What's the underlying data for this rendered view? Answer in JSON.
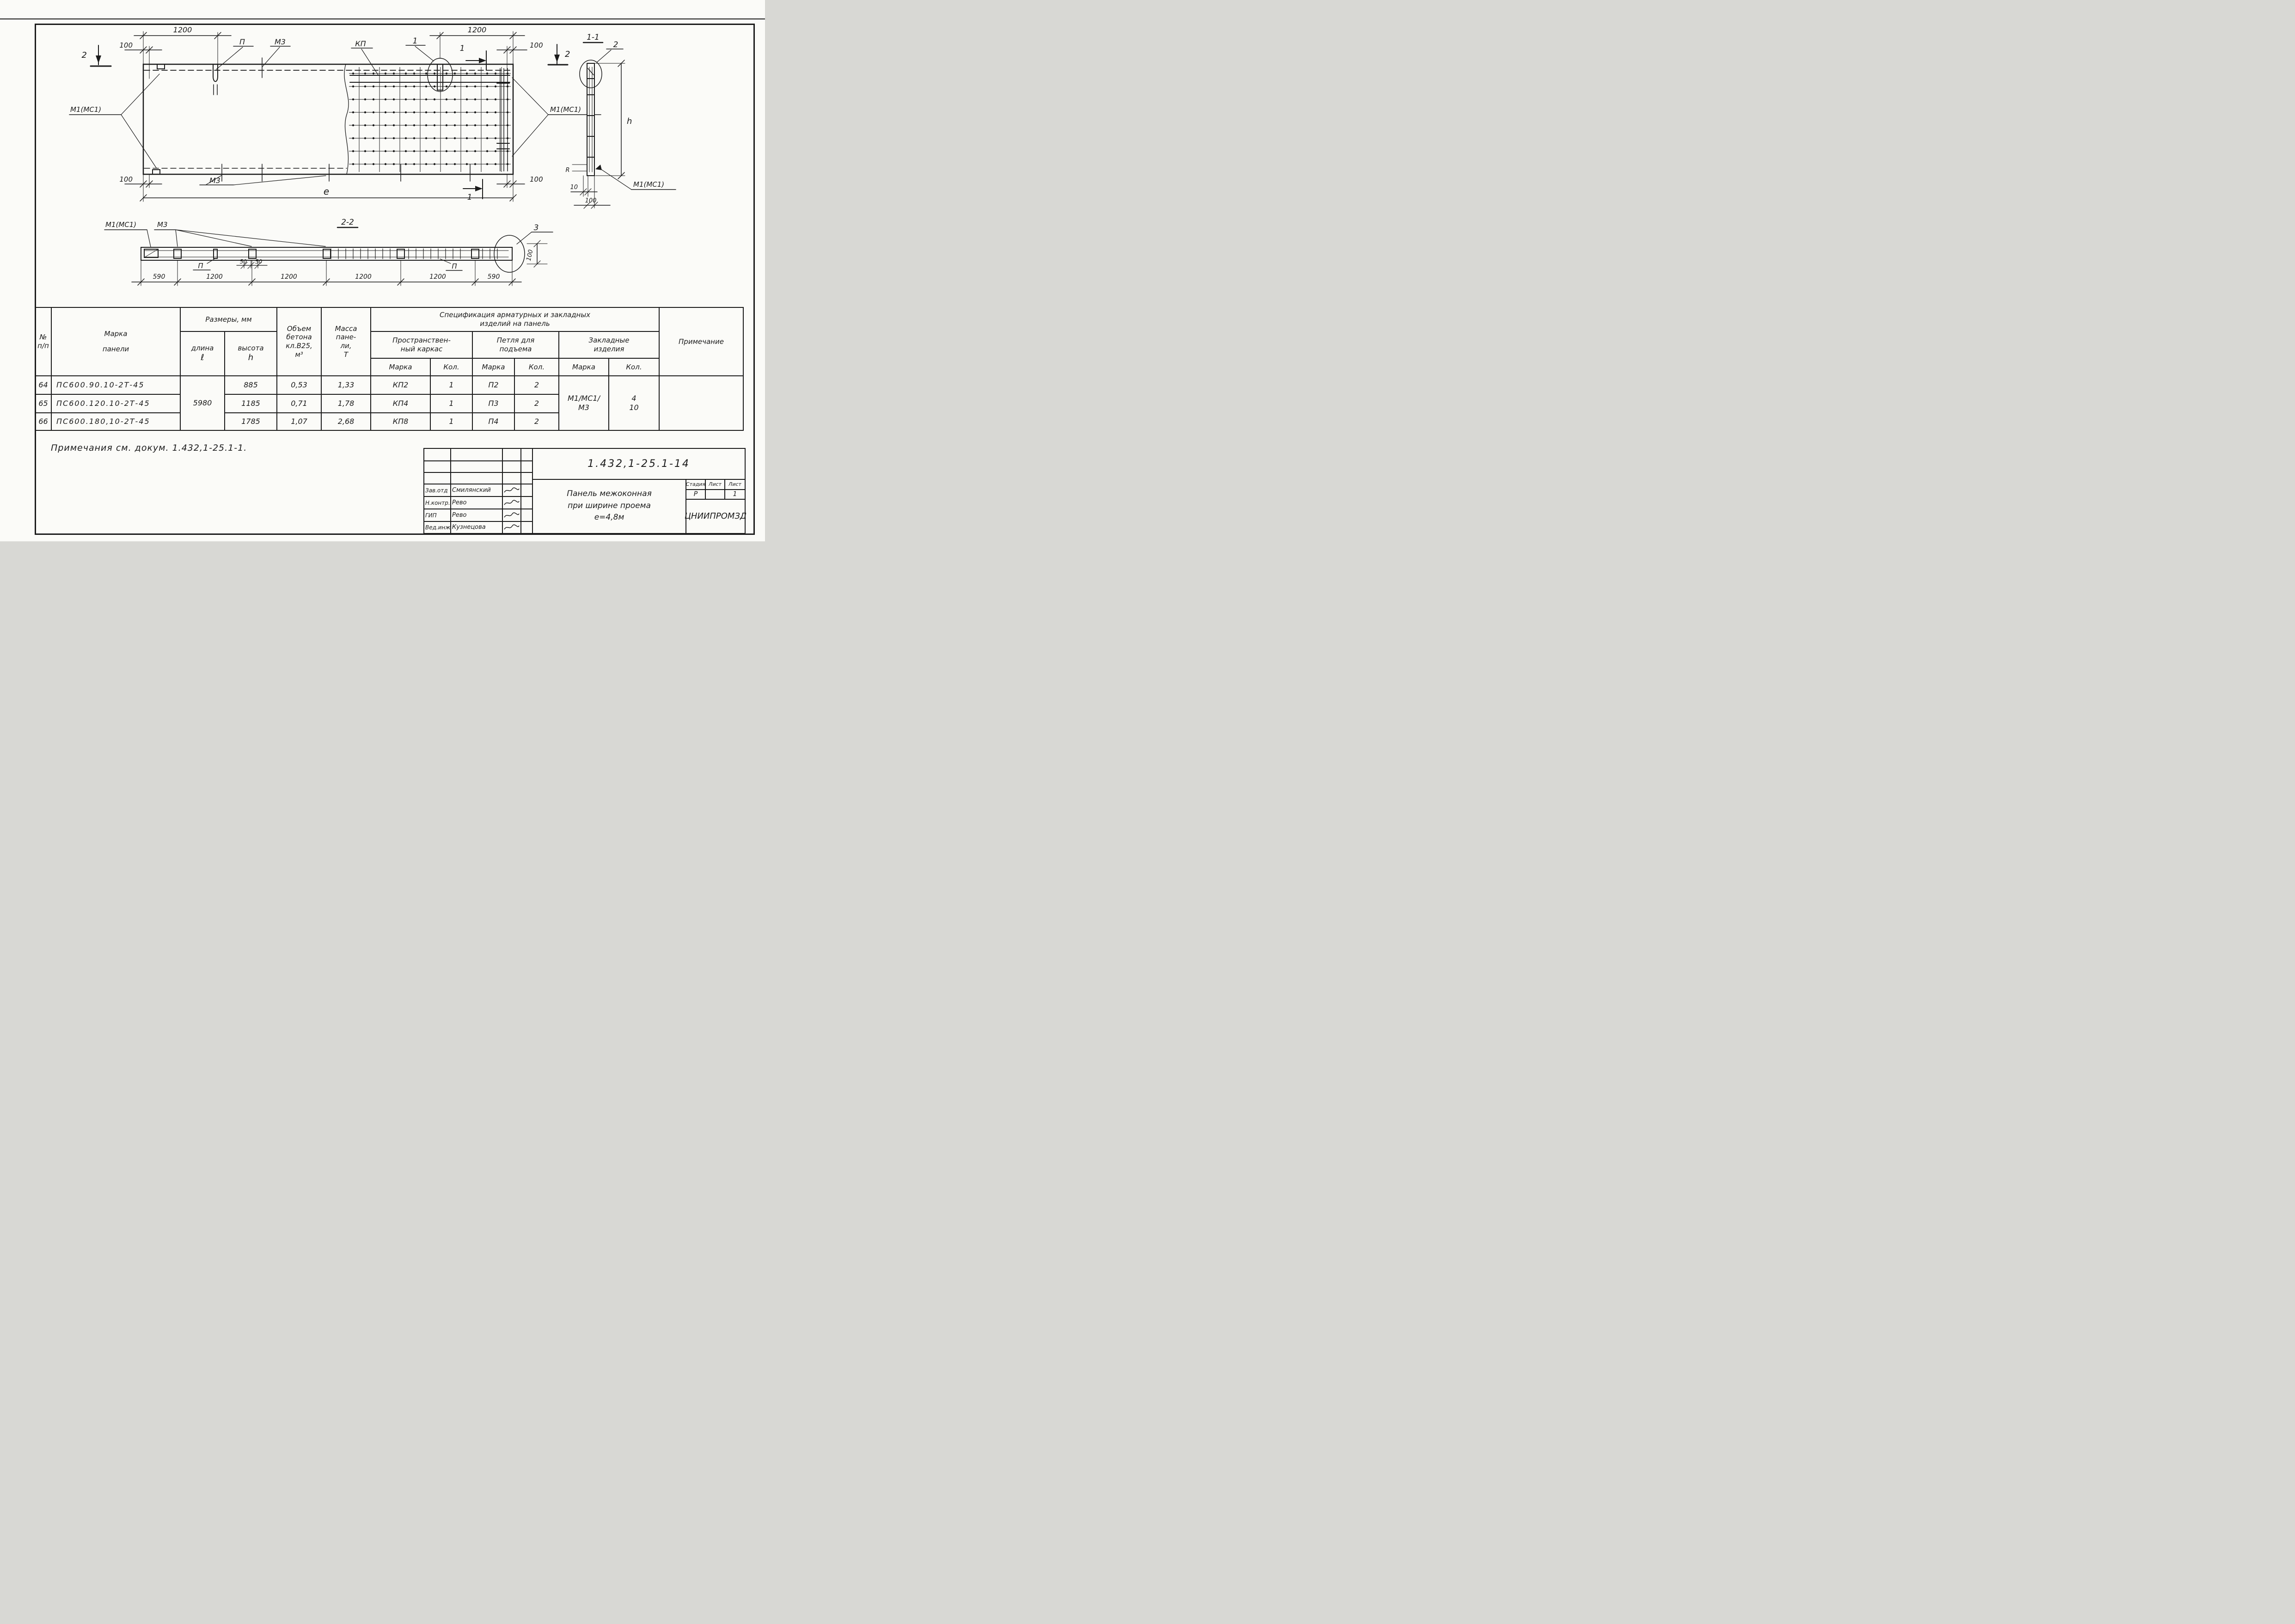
{
  "plan": {
    "dim_1200": "1200",
    "dim_100": "100",
    "dim_e": "е",
    "label_p": "П",
    "label_m3": "М3",
    "label_kp": "КП",
    "label_1": "1",
    "label_2": "2",
    "label_m1": "М1(МС1)"
  },
  "section11": {
    "title": "1-1",
    "label_2": "2",
    "label_h": "h",
    "label_r": "R",
    "dim_10": "10",
    "dim_100": "100",
    "label_m1": "М1(МС1)"
  },
  "section22": {
    "title": "2-2",
    "label_m1": "М1(МС1)",
    "label_m3": "М3",
    "label_p": "П",
    "dim_50": "50",
    "label_3": "3",
    "dim_100": "100",
    "dims": [
      "590",
      "1200",
      "1200",
      "1200",
      "1200",
      "590"
    ]
  },
  "table": {
    "headers": {
      "no_1": "№",
      "no_2": "п/п",
      "marka_1": "Марка",
      "marka_2": "панели",
      "razmery": "Размеры, мм",
      "dlina_1": "длина",
      "dlina_2": "ℓ",
      "vysota_1": "высота",
      "vysota_2": "h",
      "obyem_1": "Объем",
      "obyem_2": "бетона",
      "obyem_3": "кл.В25,",
      "obyem_4": "м³",
      "massa_1": "Масса",
      "massa_2": "пане-",
      "massa_3": "ли,",
      "massa_4": "Т",
      "spec_1": "Спецификация арматурных и закладных",
      "spec_2": "изделий на панель",
      "karkas_1": "Пространствен-",
      "karkas_2": "ный каркас",
      "petlya_1": "Петля для",
      "petlya_2": "подъема",
      "zakl_1": "Закладные",
      "zakl_2": "изделия",
      "marka": "Марка",
      "kol": "Кол.",
      "prim": "Примечание"
    },
    "merged": {
      "dlina": "5980",
      "zakl_marka_1": "М1/МС1/",
      "zakl_marka_2": "М3",
      "zakl_kol_1": "4",
      "zakl_kol_2": "10"
    },
    "rows": [
      {
        "num": "64",
        "marka": "ПС600.90.10-2Т-45",
        "vysota": "885",
        "obyem": "0,53",
        "massa": "1,33",
        "karkas_marka": "КП2",
        "karkas_kol": "1",
        "petlya_marka": "П2",
        "petlya_kol": "2"
      },
      {
        "num": "65",
        "marka": "ПС600.120.10-2Т-45",
        "vysota": "1185",
        "obyem": "0,71",
        "massa": "1,78",
        "karkas_marka": "КП4",
        "karkas_kol": "1",
        "petlya_marka": "П3",
        "petlya_kol": "2"
      },
      {
        "num": "66",
        "marka": "ПС600.180,10-2Т-45",
        "vysota": "1785",
        "obyem": "1,07",
        "massa": "2,68",
        "karkas_marka": "КП8",
        "karkas_kol": "1",
        "petlya_marka": "П4",
        "petlya_kol": "2"
      }
    ]
  },
  "notes": {
    "text": "Примечания см. докум. 1.432,1-25.1-1."
  },
  "titleblock": {
    "doc_number": "1.432,1-25.1-14",
    "sig_rows": [
      {
        "role": "Зав.отд",
        "name": "Смилянский"
      },
      {
        "role": "Н.контр.",
        "name": "Рево"
      },
      {
        "role": "ГИП",
        "name": "Рево"
      },
      {
        "role": "Вед.инж",
        "name": "Кузнецова"
      }
    ],
    "title_line_1": "Панель межоконная",
    "title_line_2": "при ширине проема",
    "title_line_3": "е=4,8м",
    "stage_label": "Стадия",
    "sheet_label": "Лист",
    "sheets_label": "Лист",
    "stage_value": "Р",
    "sheet_value": "",
    "sheets_value": "1",
    "org": "ЦНИИПРОМЗД"
  }
}
